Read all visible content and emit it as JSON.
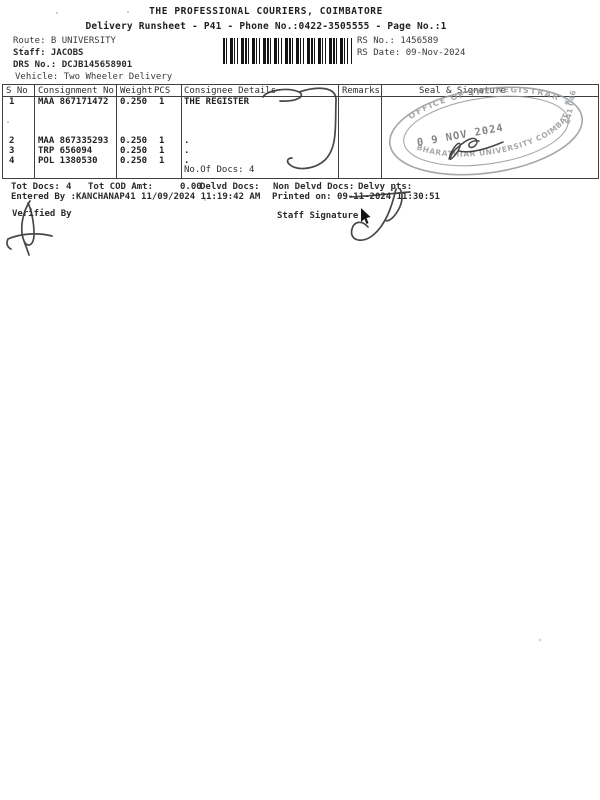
{
  "doc": {
    "title": "THE PROFESSIONAL COURIERS, COIMBATORE",
    "subtitle": "Delivery Runsheet - P41 - Phone No.:0422-3505555 - Page No.:1"
  },
  "meta": {
    "route_label": "Route:",
    "route_value": "B UNIVERSITY",
    "staff_label": "Staff:",
    "staff_value": "JACOBS",
    "drs_label": "DRS No.:",
    "drs_value": "DCJB145658901",
    "vehicle_label": "Vehicle:",
    "vehicle_value": "Two Wheeler Delivery",
    "rs_no_label": "RS No.:",
    "rs_no_value": "1456589",
    "rs_date_label": "RS Date:",
    "rs_date_value": "09-Nov-2024"
  },
  "table": {
    "headers": {
      "sno": "S No",
      "consignment": "Consignment No",
      "weight": "Weight",
      "pcs": "PCS",
      "consignee": "Consignee Details",
      "remarks": "Remarks",
      "seal": "Seal & Signature"
    },
    "rows": [
      {
        "sno": "1",
        "consignment": "MAA 867171472",
        "weight": "0.250",
        "pcs": "1",
        "consignee": "THE REGISTER"
      },
      {
        "sno": "2",
        "consignment": "MAA 867335293",
        "weight": "0.250",
        "pcs": "1",
        "consignee": "."
      },
      {
        "sno": "3",
        "consignment": "TRP 656094",
        "weight": "0.250",
        "pcs": "1",
        "consignee": "."
      },
      {
        "sno": "4",
        "consignment": "POL 1380530",
        "weight": "0.250",
        "pcs": "1",
        "consignee": "."
      }
    ],
    "docs_note": "No.Of Docs: 4"
  },
  "stamp": {
    "top_arc": "OFFICE OF THE REGISTRAR  ★",
    "bottom_arc": "BHARATHIAR UNIVERSITY COIMBATORE",
    "side_text": "641 046",
    "date": "0 9 NOV 2024",
    "ink_color": "#95999d"
  },
  "summary": {
    "tot_docs_label": "Tot Docs:",
    "tot_docs_value": "4",
    "tot_cod_label": "Tot COD Amt:",
    "tot_cod_value": "0.00",
    "delvd_label": "Delvd Docs:",
    "non_delvd_label": "Non Delvd Docs:",
    "delvy_label": "Delvy pts:"
  },
  "audit": {
    "entered_by": "Entered By :KANCHANAP41 11/09/2024 11:19:42 AM",
    "printed_on": "Printed on: 09-11-2024 11:30:51"
  },
  "signatures": {
    "verified_label": "Verified By",
    "staff_label": "Staff Signature"
  }
}
